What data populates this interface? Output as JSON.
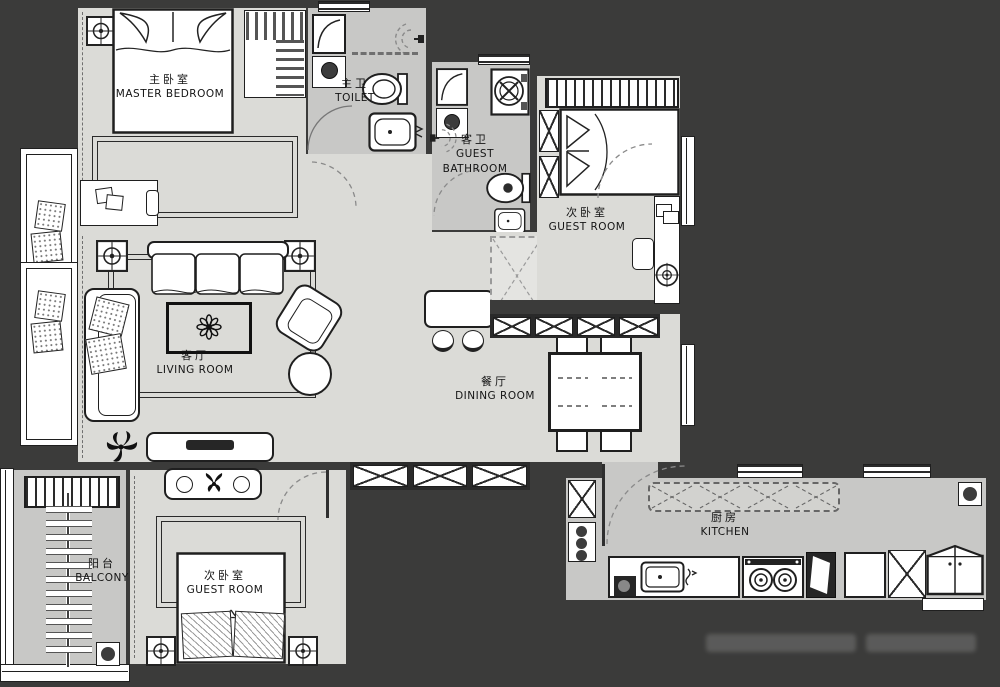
{
  "title": "Apartment Floor Plan",
  "colors": {
    "wall": "#3b3b3a",
    "room_light": "#dbdbd7",
    "room_mid": "#c8c8c6",
    "line": "#1f1f1f",
    "white": "#ffffff"
  },
  "rooms": [
    {
      "id": "master-bedroom",
      "zh": "主卧室",
      "en": "MASTER BEDROOM"
    },
    {
      "id": "toilet",
      "zh": "主卫",
      "en": "TOILET"
    },
    {
      "id": "guest-bathroom",
      "zh": "客卫",
      "en": "GUEST BATHROOM"
    },
    {
      "id": "guest-room-north",
      "zh": "次卧室",
      "en": "GUEST ROOM"
    },
    {
      "id": "living-room",
      "zh": "客厅",
      "en": "LIVING ROOM"
    },
    {
      "id": "dining-room",
      "zh": "餐厅",
      "en": "DINING ROOM"
    },
    {
      "id": "balcony",
      "zh": "阳台",
      "en": "BALCONY"
    },
    {
      "id": "guest-room-south",
      "zh": "次卧室",
      "en": "GUEST ROOM"
    },
    {
      "id": "kitchen",
      "zh": "厨房",
      "en": "KITCHEN"
    }
  ]
}
